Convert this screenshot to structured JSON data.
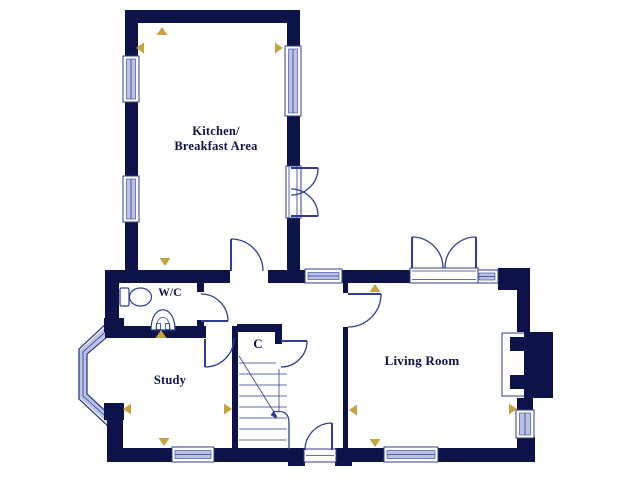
{
  "colors": {
    "bg": "#ffffff",
    "wall": "#0d1248",
    "line": "#2f3e95",
    "glazing": "#bcc2e6",
    "gold": "#c8a23f",
    "text": "#0d1248"
  },
  "rooms": {
    "kitchen": {
      "lines": [
        "Kitchen/",
        "Breakfast Area"
      ]
    },
    "wc": {
      "label": "W/C"
    },
    "study": {
      "label": "Study"
    },
    "cupboard": {
      "label": "C"
    },
    "living_room": {
      "label": "Living Room"
    }
  },
  "icons": {
    "toilet-icon": "cistern rectangle with oval bowl outline",
    "basin-icon": "domed wash basin outline with taps",
    "stairs-icon": "stair treads with diagonal break line and handrail",
    "fireplace-icon": "chimney breast with firebox recess",
    "bay-window-icon": "three-segment angled glazing bay",
    "dimension-arrow-icon": "small gold triangle dimension marker",
    "door-icon": "quarter-circle door swing arc",
    "window-icon": "glazing band set in wall opening"
  }
}
